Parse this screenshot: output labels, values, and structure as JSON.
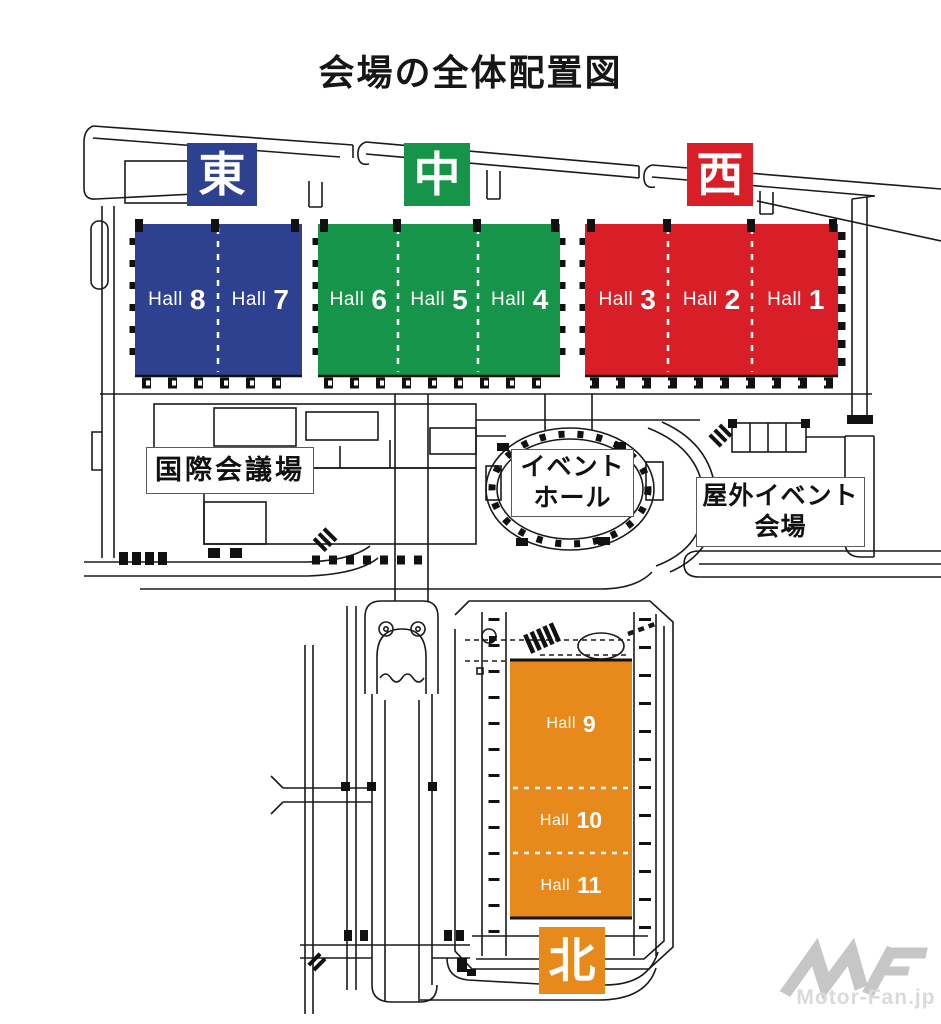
{
  "title": "会場の全体配置図",
  "areas": {
    "east": {
      "label": "東",
      "color": "#2e4191"
    },
    "center": {
      "label": "中",
      "color": "#16954a"
    },
    "west": {
      "label": "西",
      "color": "#d81e26"
    },
    "north": {
      "label": "北",
      "color": "#e8891b"
    }
  },
  "hall_groups": {
    "east": {
      "color": "#2e4191",
      "halls": [
        {
          "word": "Hall",
          "number": "8"
        },
        {
          "word": "Hall",
          "number": "7"
        }
      ]
    },
    "center": {
      "color": "#16954a",
      "halls": [
        {
          "word": "Hall",
          "number": "6"
        },
        {
          "word": "Hall",
          "number": "5"
        },
        {
          "word": "Hall",
          "number": "4"
        }
      ]
    },
    "west": {
      "color": "#d81e26",
      "halls": [
        {
          "word": "Hall",
          "number": "3"
        },
        {
          "word": "Hall",
          "number": "2"
        },
        {
          "word": "Hall",
          "number": "1"
        }
      ]
    },
    "north": {
      "color": "#e8891b",
      "halls": [
        {
          "word": "Hall",
          "number": "9"
        },
        {
          "word": "Hall",
          "number": "10"
        },
        {
          "word": "Hall",
          "number": "11"
        }
      ]
    }
  },
  "facilities": {
    "conference_hall": "国際会議場",
    "event_hall": {
      "line1": "イベント",
      "line2": "ホール"
    },
    "outdoor_venue": {
      "line1": "屋外イベント",
      "line2": "会場"
    }
  },
  "watermark": {
    "logo": "MF",
    "text": "Motor-Fan.jp",
    "color": "#c6c6c6"
  },
  "line_color": "#1a1a1a"
}
